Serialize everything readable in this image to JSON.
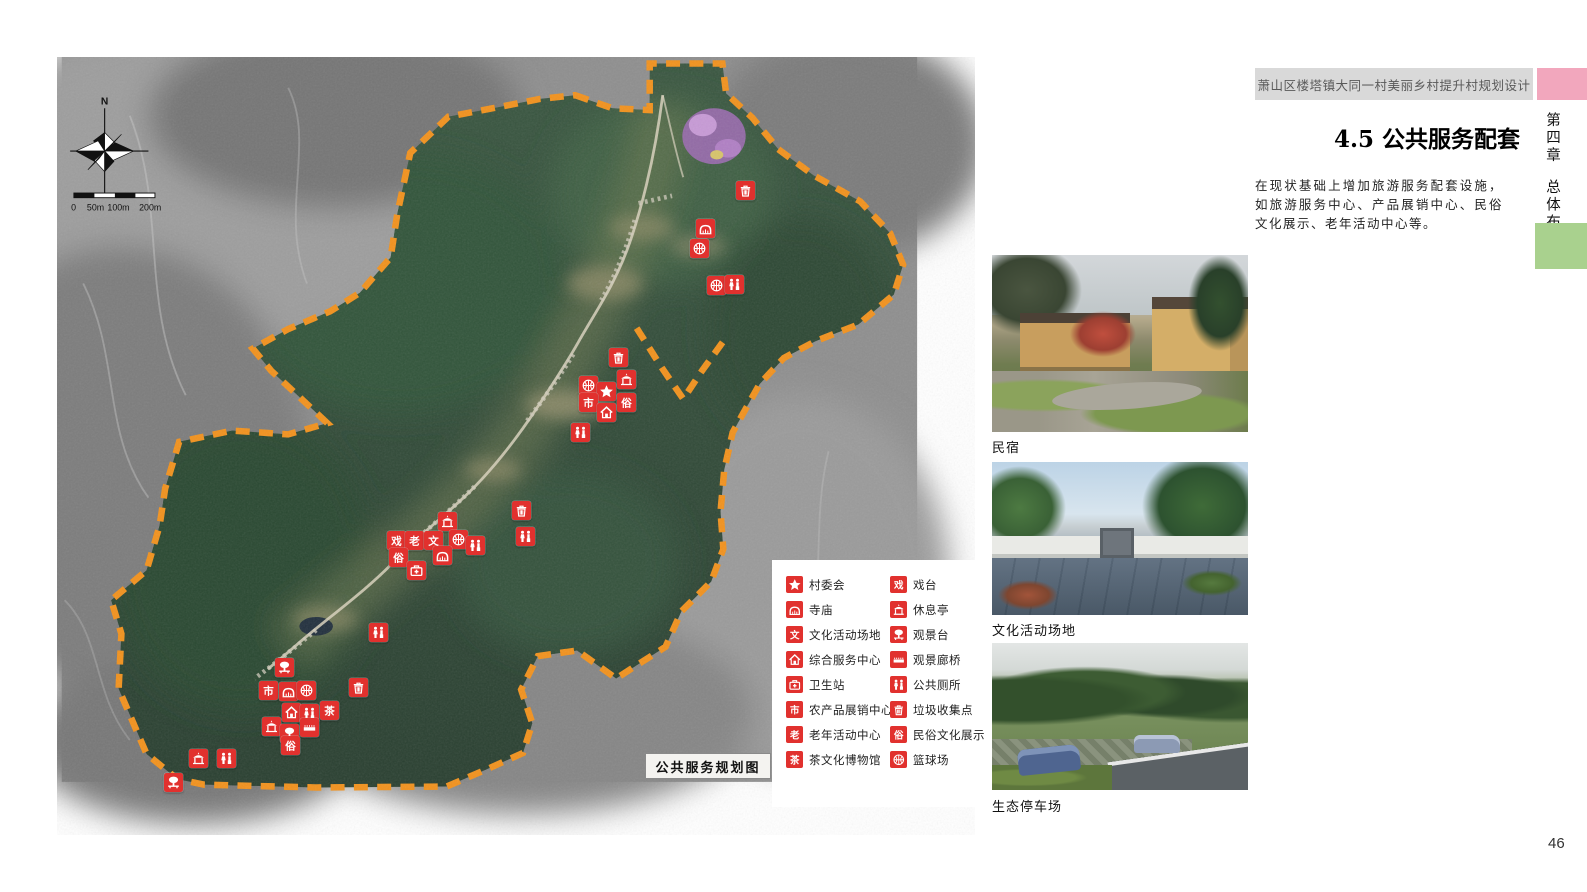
{
  "page": {
    "number": "46"
  },
  "header": {
    "project_title": "萧山区楼塔镇大同一村美丽乡村提升村规划设计"
  },
  "chapter": {
    "number": "第四章",
    "title": "总体布局"
  },
  "section": {
    "title": "4.5 公共服务配套",
    "paragraph": "在现状基础上增加旅游服务配套设施，如旅游服务中心、产品展销中心、民俗文化展示、老年活动中心等。"
  },
  "map": {
    "label": "公共服务规划图",
    "compass": {
      "north_label": "N"
    },
    "scale_bar": {
      "labels": [
        "0",
        "50m",
        "100m",
        "200m"
      ]
    },
    "markers": [
      {
        "type": "trash",
        "x": 688,
        "y": 133
      },
      {
        "type": "temple",
        "x": 648,
        "y": 171
      },
      {
        "type": "basketball",
        "x": 642,
        "y": 191
      },
      {
        "type": "basketball",
        "x": 659,
        "y": 228
      },
      {
        "type": "toilet",
        "x": 677,
        "y": 227
      },
      {
        "type": "trash",
        "x": 561,
        "y": 300
      },
      {
        "type": "basketball",
        "x": 531,
        "y": 328
      },
      {
        "type": "pavilion",
        "x": 569,
        "y": 322
      },
      {
        "type": "star",
        "x": 549,
        "y": 334
      },
      {
        "type": "shi",
        "x": 531,
        "y": 345
      },
      {
        "type": "su",
        "x": 569,
        "y": 345
      },
      {
        "type": "house",
        "x": 549,
        "y": 355
      },
      {
        "type": "toilet",
        "x": 523,
        "y": 375
      },
      {
        "type": "trash",
        "x": 464,
        "y": 453
      },
      {
        "type": "toilet",
        "x": 468,
        "y": 479
      },
      {
        "type": "pavilion",
        "x": 390,
        "y": 464
      },
      {
        "type": "basketball",
        "x": 401,
        "y": 482
      },
      {
        "type": "xi",
        "x": 339,
        "y": 483
      },
      {
        "type": "lao",
        "x": 357,
        "y": 483
      },
      {
        "type": "wen",
        "x": 376,
        "y": 483
      },
      {
        "type": "toilet",
        "x": 418,
        "y": 488
      },
      {
        "type": "su",
        "x": 341,
        "y": 500
      },
      {
        "type": "temple",
        "x": 385,
        "y": 498
      },
      {
        "type": "health",
        "x": 359,
        "y": 513
      },
      {
        "type": "toilet",
        "x": 321,
        "y": 575
      },
      {
        "type": "viewpoint",
        "x": 227,
        "y": 610
      },
      {
        "type": "shi",
        "x": 211,
        "y": 633
      },
      {
        "type": "temple",
        "x": 231,
        "y": 634
      },
      {
        "type": "basketball",
        "x": 249,
        "y": 633
      },
      {
        "type": "trash",
        "x": 301,
        "y": 630
      },
      {
        "type": "house",
        "x": 234,
        "y": 655
      },
      {
        "type": "toilet",
        "x": 252,
        "y": 656
      },
      {
        "type": "cha",
        "x": 272,
        "y": 653
      },
      {
        "type": "pavilion",
        "x": 214,
        "y": 669
      },
      {
        "type": "viewpoint",
        "x": 232,
        "y": 676
      },
      {
        "type": "bridge",
        "x": 252,
        "y": 670
      },
      {
        "type": "su",
        "x": 233,
        "y": 688
      },
      {
        "type": "pavilion",
        "x": 141,
        "y": 701
      },
      {
        "type": "toilet",
        "x": 169,
        "y": 701
      },
      {
        "type": "viewpoint",
        "x": 116,
        "y": 725
      }
    ]
  },
  "legend": {
    "items_left": [
      {
        "icon": "star",
        "label": "村委会"
      },
      {
        "icon": "temple",
        "label": "寺庙"
      },
      {
        "icon": "wen",
        "label": "文化活动场地"
      },
      {
        "icon": "house",
        "label": "综合服务中心"
      },
      {
        "icon": "health",
        "label": "卫生站"
      },
      {
        "icon": "shi",
        "label": "农产品展销中心"
      },
      {
        "icon": "lao",
        "label": "老年活动中心"
      },
      {
        "icon": "cha",
        "label": "茶文化博物馆"
      }
    ],
    "items_right": [
      {
        "icon": "xi",
        "label": "戏台"
      },
      {
        "icon": "pavilion",
        "label": "休息亭"
      },
      {
        "icon": "viewpoint",
        "label": "观景台"
      },
      {
        "icon": "bridge",
        "label": "观景廊桥"
      },
      {
        "icon": "toilet",
        "label": "公共厕所"
      },
      {
        "icon": "trash",
        "label": "垃圾收集点"
      },
      {
        "icon": "su",
        "label": "民俗文化展示"
      },
      {
        "icon": "basketball",
        "label": "篮球场"
      }
    ]
  },
  "icon_chars": {
    "wen": "文",
    "shi": "市",
    "lao": "老",
    "cha": "茶",
    "xi": "戏",
    "su": "俗"
  },
  "photos": [
    {
      "caption": "民宿",
      "kind": "guesthouse"
    },
    {
      "caption": "文化活动场地",
      "kind": "plaza"
    },
    {
      "caption": "生态停车场",
      "kind": "parking"
    }
  ],
  "colors": {
    "marker_red": "#E1312E",
    "boundary_orange": "#F2921D",
    "chapter_pink": "#F2A7BD",
    "chapter_green": "#A9D18E",
    "header_gray": "#D9D9D9"
  }
}
